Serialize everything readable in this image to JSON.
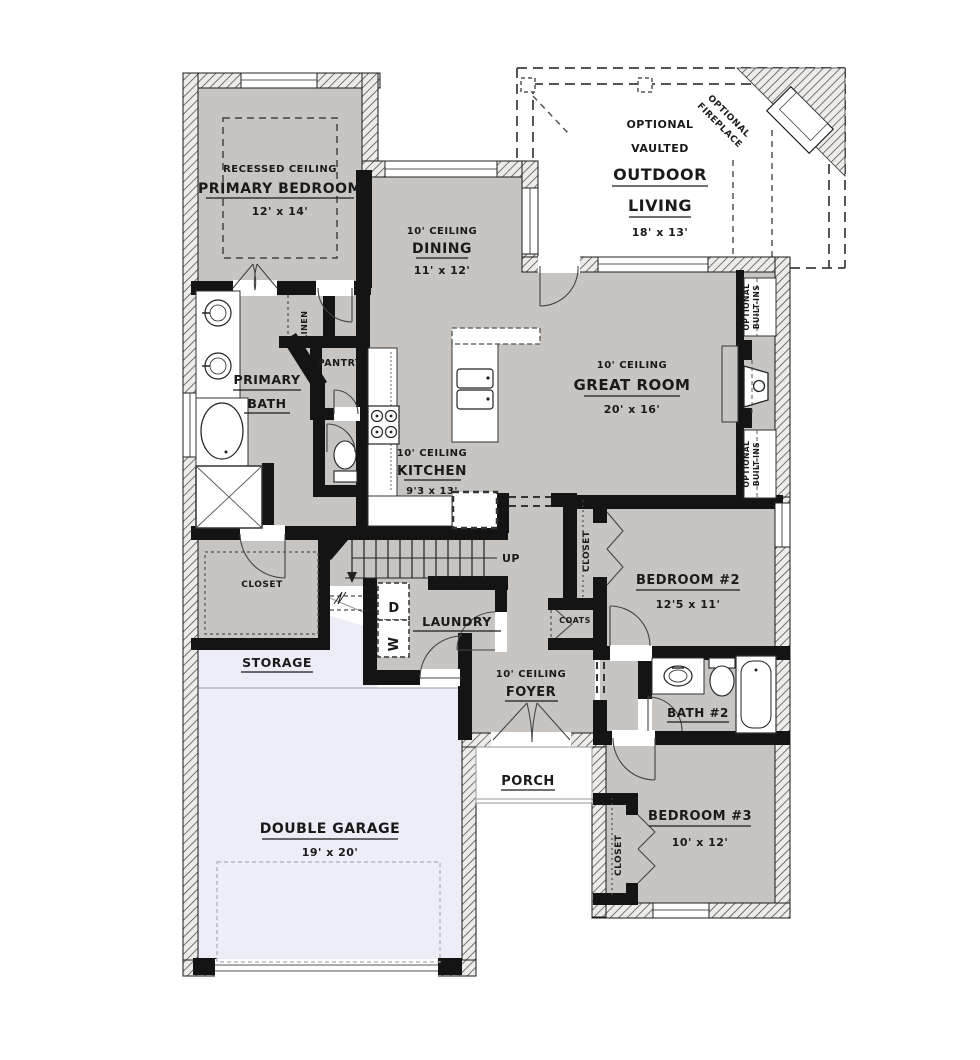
{
  "plan": {
    "colors": {
      "room_fill": "#c8c4c1",
      "garage_fill": "#ecedf6",
      "wall": "#141414",
      "text": "#1a1a1a"
    },
    "rooms": {
      "primary_bedroom": {
        "note": "RECESSED CEILING",
        "name": "PRIMARY BEDROOM",
        "dims": "12' x 14'"
      },
      "dining": {
        "ceiling": "10' CEILING",
        "name": "DINING",
        "dims": "11' x 12'"
      },
      "outdoor_living": {
        "line1": "OPTIONAL",
        "line2": "VAULTED",
        "line3": "OUTDOOR",
        "line4": "LIVING",
        "dims": "18' x 13'"
      },
      "optional_fireplace": {
        "line1": "OPTIONAL",
        "line2": "FIREPLACE"
      },
      "great_room": {
        "ceiling": "10' CEILING",
        "name": "GREAT ROOM",
        "dims": "20' x 16'"
      },
      "kitchen": {
        "ceiling": "10' CEILING",
        "name": "KITCHEN",
        "dims": "9'3 x 13'"
      },
      "primary_bath": {
        "line1": "PRIMARY",
        "line2": "BATH"
      },
      "pantry": {
        "name": "PANTRY"
      },
      "linen": {
        "name": "LINEN"
      },
      "primary_closet": {
        "name": "CLOSET"
      },
      "storage": {
        "name": "STORAGE"
      },
      "laundry": {
        "name": "LAUNDRY",
        "dryer": "D",
        "washer": "W"
      },
      "stairs": {
        "label": "UP"
      },
      "foyer": {
        "ceiling": "10' CEILING",
        "name": "FOYER"
      },
      "coats": {
        "name": "COATS"
      },
      "porch": {
        "name": "PORCH"
      },
      "garage": {
        "name": "DOUBLE GARAGE",
        "dims": "19' x 20'"
      },
      "bedroom2": {
        "name": "BEDROOM #2",
        "dims": "12'5 x 11'"
      },
      "bedroom2_closet": {
        "name": "CLOSET"
      },
      "bath2": {
        "name": "BATH #2"
      },
      "bedroom3": {
        "name": "BEDROOM #3",
        "dims": "10' x 12'"
      },
      "bedroom3_closet": {
        "name": "CLOSET"
      },
      "built_ins_top": {
        "line1": "OPTIONAL",
        "line2": "BUILT-INS"
      },
      "built_ins_bottom": {
        "line1": "OPTIONAL",
        "line2": "BUILT-INS"
      }
    }
  }
}
